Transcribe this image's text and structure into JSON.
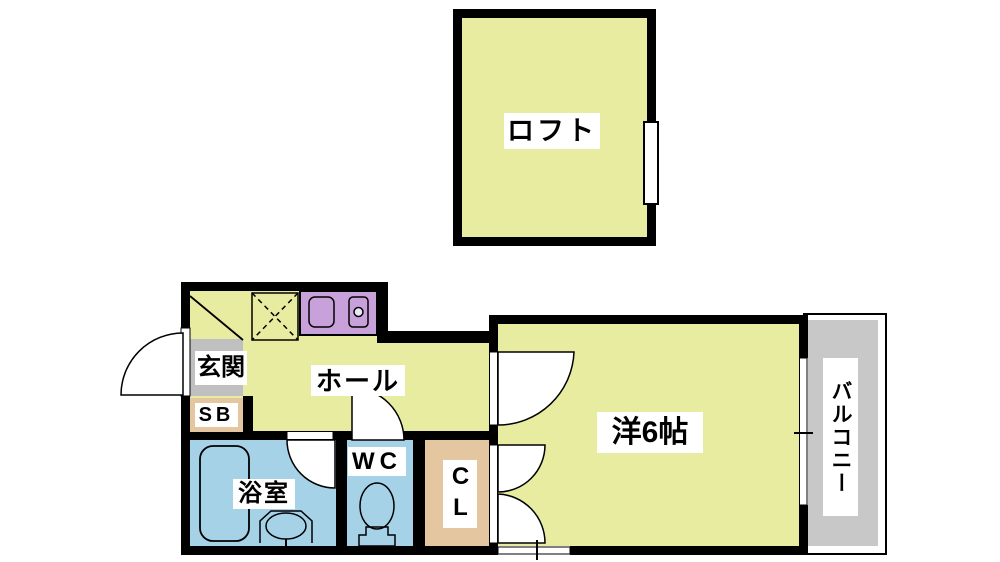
{
  "floorplan": {
    "labels": {
      "loft": "ロフト",
      "entrance": "玄関",
      "shoe_box": "SB",
      "hall": "ホール",
      "bathroom": "浴室",
      "toilet": "WC",
      "closet": "CL",
      "western_room": "洋6帖",
      "balcony": "バルコニー"
    },
    "colors": {
      "wall": "#000000",
      "room_yellow": "#e8eca0",
      "wet_area_blue": "#a6d2e8",
      "kitchen_purple": "#c8a0da",
      "entrance_gray": "#c0c0c0",
      "closet_tan": "#e4c6a0",
      "balcony_gray": "#c8c8c8",
      "label_bg": "#ffffff"
    }
  }
}
